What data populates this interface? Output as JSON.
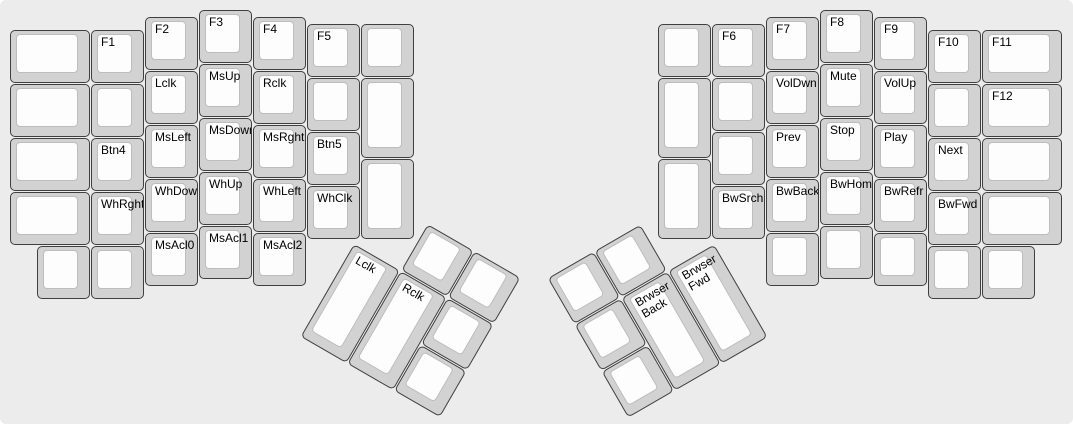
{
  "keyboard": {
    "unit_px": 54,
    "margin": {
      "x": 10,
      "y": 10
    },
    "colors": {
      "background": "#ececec",
      "cap_base": "#d2d2d2",
      "cap_border": "#3f3f3f",
      "cap_top": "#fdfdfd",
      "cap_top_border": "#bdbdbd",
      "label": "#000000"
    },
    "left_main": {
      "keys": [
        {
          "x": 0,
          "y": 0.375,
          "w": 1.5,
          "h": 1,
          "label": ""
        },
        {
          "x": 0,
          "y": 1.375,
          "w": 1.5,
          "h": 1,
          "label": ""
        },
        {
          "x": 0,
          "y": 2.375,
          "w": 1.5,
          "h": 1,
          "label": ""
        },
        {
          "x": 0,
          "y": 3.375,
          "w": 1.5,
          "h": 1,
          "label": ""
        },
        {
          "x": 1.5,
          "y": 0.375,
          "w": 1,
          "h": 1,
          "label": "F1"
        },
        {
          "x": 1.5,
          "y": 1.375,
          "w": 1,
          "h": 1,
          "label": ""
        },
        {
          "x": 1.5,
          "y": 2.375,
          "w": 1,
          "h": 1,
          "label": "Btn4"
        },
        {
          "x": 1.5,
          "y": 3.375,
          "w": 1,
          "h": 1,
          "label": "WhRght"
        },
        {
          "x": 0.5,
          "y": 4.375,
          "w": 1,
          "h": 1,
          "label": ""
        },
        {
          "x": 1.5,
          "y": 4.375,
          "w": 1,
          "h": 1,
          "label": ""
        },
        {
          "x": 2.5,
          "y": 0.125,
          "w": 1,
          "h": 1,
          "label": "F2"
        },
        {
          "x": 2.5,
          "y": 1.125,
          "w": 1,
          "h": 1,
          "label": "Lclk"
        },
        {
          "x": 2.5,
          "y": 2.125,
          "w": 1,
          "h": 1,
          "label": "MsLeft"
        },
        {
          "x": 2.5,
          "y": 3.125,
          "w": 1,
          "h": 1,
          "label": "WhDown"
        },
        {
          "x": 2.5,
          "y": 4.125,
          "w": 1,
          "h": 1,
          "label": "MsAcl0"
        },
        {
          "x": 3.5,
          "y": 0,
          "w": 1,
          "h": 1,
          "label": "F3"
        },
        {
          "x": 3.5,
          "y": 1,
          "w": 1,
          "h": 1,
          "label": "MsUp"
        },
        {
          "x": 3.5,
          "y": 2,
          "w": 1,
          "h": 1,
          "label": "MsDown"
        },
        {
          "x": 3.5,
          "y": 3,
          "w": 1,
          "h": 1,
          "label": "WhUp"
        },
        {
          "x": 3.5,
          "y": 4,
          "w": 1,
          "h": 1,
          "label": "MsAcl1"
        },
        {
          "x": 4.5,
          "y": 0.125,
          "w": 1,
          "h": 1,
          "label": "F4"
        },
        {
          "x": 4.5,
          "y": 1.125,
          "w": 1,
          "h": 1,
          "label": "Rclk"
        },
        {
          "x": 4.5,
          "y": 2.125,
          "w": 1,
          "h": 1,
          "label": "MsRght"
        },
        {
          "x": 4.5,
          "y": 3.125,
          "w": 1,
          "h": 1,
          "label": "WhLeft"
        },
        {
          "x": 4.5,
          "y": 4.125,
          "w": 1,
          "h": 1,
          "label": "MsAcl2"
        },
        {
          "x": 5.5,
          "y": 0.25,
          "w": 1,
          "h": 1,
          "label": "F5"
        },
        {
          "x": 5.5,
          "y": 1.25,
          "w": 1,
          "h": 1,
          "label": ""
        },
        {
          "x": 5.5,
          "y": 2.25,
          "w": 1,
          "h": 1,
          "label": "Btn5"
        },
        {
          "x": 5.5,
          "y": 3.25,
          "w": 1,
          "h": 1,
          "label": "WhClk"
        },
        {
          "x": 6.5,
          "y": 0.25,
          "w": 1,
          "h": 1,
          "label": ""
        },
        {
          "x": 6.5,
          "y": 1.25,
          "w": 1,
          "h": 1.5,
          "label": ""
        },
        {
          "x": 6.5,
          "y": 2.75,
          "w": 1,
          "h": 1.5,
          "label": ""
        }
      ]
    },
    "right_main": {
      "keys": [
        {
          "x": 12,
          "y": 0.25,
          "w": 1,
          "h": 1,
          "label": ""
        },
        {
          "x": 12,
          "y": 1.25,
          "w": 1,
          "h": 1.5,
          "label": ""
        },
        {
          "x": 12,
          "y": 2.75,
          "w": 1,
          "h": 1.5,
          "label": ""
        },
        {
          "x": 13,
          "y": 0.25,
          "w": 1,
          "h": 1,
          "label": "F6"
        },
        {
          "x": 13,
          "y": 1.25,
          "w": 1,
          "h": 1,
          "label": ""
        },
        {
          "x": 13,
          "y": 2.25,
          "w": 1,
          "h": 1,
          "label": ""
        },
        {
          "x": 13,
          "y": 3.25,
          "w": 1,
          "h": 1,
          "label": "BwSrch"
        },
        {
          "x": 14,
          "y": 0.125,
          "w": 1,
          "h": 1,
          "label": "F7"
        },
        {
          "x": 14,
          "y": 1.125,
          "w": 1,
          "h": 1,
          "label": "VolDwn"
        },
        {
          "x": 14,
          "y": 2.125,
          "w": 1,
          "h": 1,
          "label": "Prev"
        },
        {
          "x": 14,
          "y": 3.125,
          "w": 1,
          "h": 1,
          "label": "BwBack"
        },
        {
          "x": 14,
          "y": 4.125,
          "w": 1,
          "h": 1,
          "label": ""
        },
        {
          "x": 15,
          "y": 0,
          "w": 1,
          "h": 1,
          "label": "F8"
        },
        {
          "x": 15,
          "y": 1,
          "w": 1,
          "h": 1,
          "label": "Mute"
        },
        {
          "x": 15,
          "y": 2,
          "w": 1,
          "h": 1,
          "label": "Stop"
        },
        {
          "x": 15,
          "y": 3,
          "w": 1,
          "h": 1,
          "label": "BwHome"
        },
        {
          "x": 15,
          "y": 4,
          "w": 1,
          "h": 1,
          "label": ""
        },
        {
          "x": 16,
          "y": 0.125,
          "w": 1,
          "h": 1,
          "label": "F9"
        },
        {
          "x": 16,
          "y": 1.125,
          "w": 1,
          "h": 1,
          "label": "VolUp"
        },
        {
          "x": 16,
          "y": 2.125,
          "w": 1,
          "h": 1,
          "label": "Play"
        },
        {
          "x": 16,
          "y": 3.125,
          "w": 1,
          "h": 1,
          "label": "BwRefr"
        },
        {
          "x": 16,
          "y": 4.125,
          "w": 1,
          "h": 1,
          "label": ""
        },
        {
          "x": 17,
          "y": 0.375,
          "w": 1,
          "h": 1,
          "label": "F10"
        },
        {
          "x": 17,
          "y": 1.375,
          "w": 1,
          "h": 1,
          "label": ""
        },
        {
          "x": 17,
          "y": 2.375,
          "w": 1,
          "h": 1,
          "label": "Next"
        },
        {
          "x": 17,
          "y": 3.375,
          "w": 1,
          "h": 1,
          "label": "BwFwd"
        },
        {
          "x": 17,
          "y": 4.375,
          "w": 1,
          "h": 1,
          "label": ""
        },
        {
          "x": 18,
          "y": 0.375,
          "w": 1.5,
          "h": 1,
          "label": "F11"
        },
        {
          "x": 18,
          "y": 1.375,
          "w": 1.5,
          "h": 1,
          "label": "F12"
        },
        {
          "x": 18,
          "y": 2.375,
          "w": 1.5,
          "h": 1,
          "label": ""
        },
        {
          "x": 18,
          "y": 3.375,
          "w": 1.5,
          "h": 1,
          "label": ""
        },
        {
          "x": 18,
          "y": 4.375,
          "w": 1,
          "h": 1,
          "label": ""
        }
      ]
    },
    "left_thumb": {
      "origin_px": {
        "x": 354,
        "y": 244
      },
      "angle_deg": 30,
      "keys": [
        {
          "x": 1,
          "y": -1,
          "w": 1,
          "h": 1,
          "label": ""
        },
        {
          "x": 2,
          "y": -1,
          "w": 1,
          "h": 1,
          "label": ""
        },
        {
          "x": 0,
          "y": 0,
          "w": 1,
          "h": 2,
          "label": "Lclk"
        },
        {
          "x": 1,
          "y": 0,
          "w": 1,
          "h": 2,
          "label": "Rclk"
        },
        {
          "x": 2,
          "y": 0,
          "w": 1,
          "h": 1,
          "label": ""
        },
        {
          "x": 2,
          "y": 1,
          "w": 1,
          "h": 1,
          "label": ""
        }
      ]
    },
    "right_thumb": {
      "origin_px": {
        "x": 715,
        "y": 243.5
      },
      "angle_deg": -30,
      "keys": [
        {
          "x": -3,
          "y": -1,
          "w": 1,
          "h": 1,
          "label": ""
        },
        {
          "x": -2,
          "y": -1,
          "w": 1,
          "h": 1,
          "label": ""
        },
        {
          "x": -3,
          "y": 0,
          "w": 1,
          "h": 1,
          "label": ""
        },
        {
          "x": -2,
          "y": 0,
          "w": 1,
          "h": 2,
          "label": "Brwser\nBack"
        },
        {
          "x": -1,
          "y": 0,
          "w": 1,
          "h": 2,
          "label": "Brwser\nFwd"
        },
        {
          "x": -3,
          "y": 1,
          "w": 1,
          "h": 1,
          "label": ""
        }
      ]
    }
  }
}
